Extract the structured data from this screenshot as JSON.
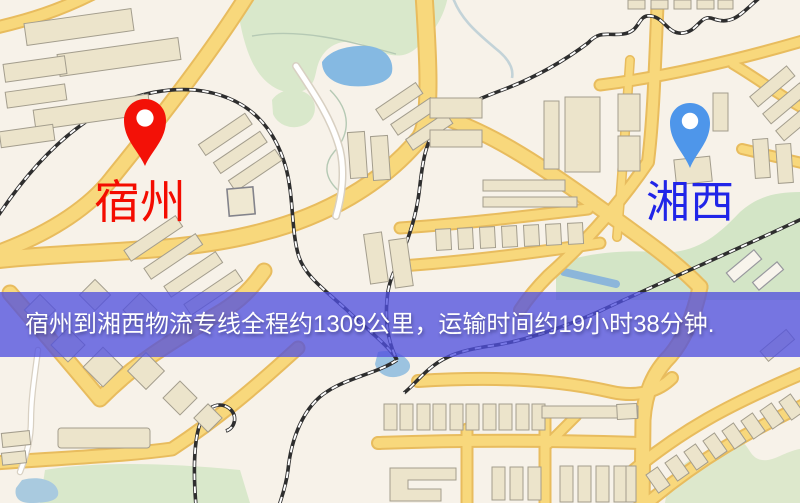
{
  "window": {
    "width": 800,
    "height": 503
  },
  "map": {
    "description": "city road map with logistics route overlay",
    "palette": {
      "background": "#f7f2e9",
      "road_yellow": "#f8d87c",
      "road_casing": "#e8bc5e",
      "road_white": "#ffffff",
      "park_green": "#d9e8cb",
      "water_blue": "#85b9e2",
      "building_fill": "#ece4cb",
      "building_stroke": "#a39d8d",
      "railway": "#2e2e2e"
    }
  },
  "markers": {
    "origin": {
      "name": "宿州",
      "pin_color": "#f31107",
      "label_color": "#f40c00"
    },
    "destination": {
      "name": "湘西",
      "pin_color": "#4e96ea",
      "label_color": "#2125e8"
    }
  },
  "banner": {
    "text": "宿州到湘西物流专线全程约1309公里，运输时间约19小时38分钟.",
    "background_color": "#5050de",
    "text_color": "#ffffff",
    "distance_text": "约1309公里",
    "duration_text": "约19小时38分钟"
  }
}
